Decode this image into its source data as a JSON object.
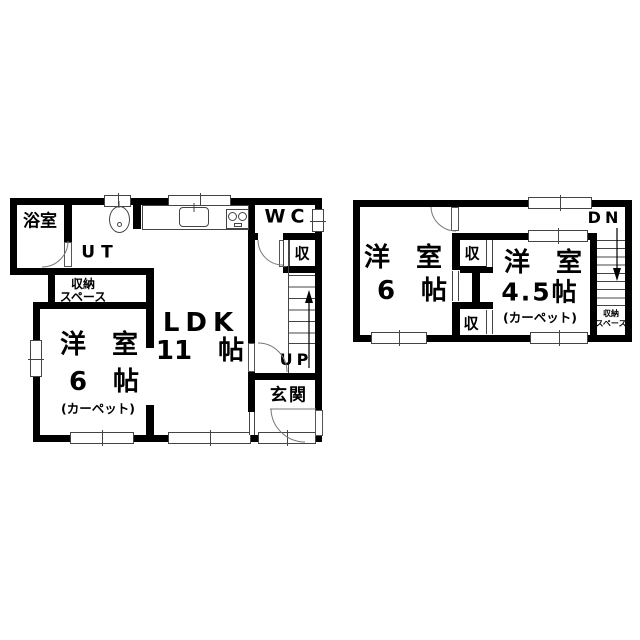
{
  "floor1": {
    "bath": "浴室",
    "ut": "UT",
    "wc": "WC",
    "closet": "収",
    "storage1": "収納",
    "storage2": "スペース",
    "ldk": "LDK",
    "ldk_size": "11　帖",
    "west_room": "洋　室",
    "west_size": "6　帖",
    "west_note": "(カーペット)",
    "up": "UP",
    "entrance": "玄関"
  },
  "floor2": {
    "west6_room": "洋　室",
    "west6_size": "6　帖",
    "closet_upper": "収",
    "closet_lower": "収",
    "west45_room": "洋　室",
    "west45_size": "4.5帖",
    "west45_note": "(カーペット)",
    "dn": "DN",
    "storage1": "収納",
    "storage2": "スペース"
  },
  "colors": {
    "wall": "#000000",
    "thin_line": "#444444",
    "background": "#ffffff"
  }
}
